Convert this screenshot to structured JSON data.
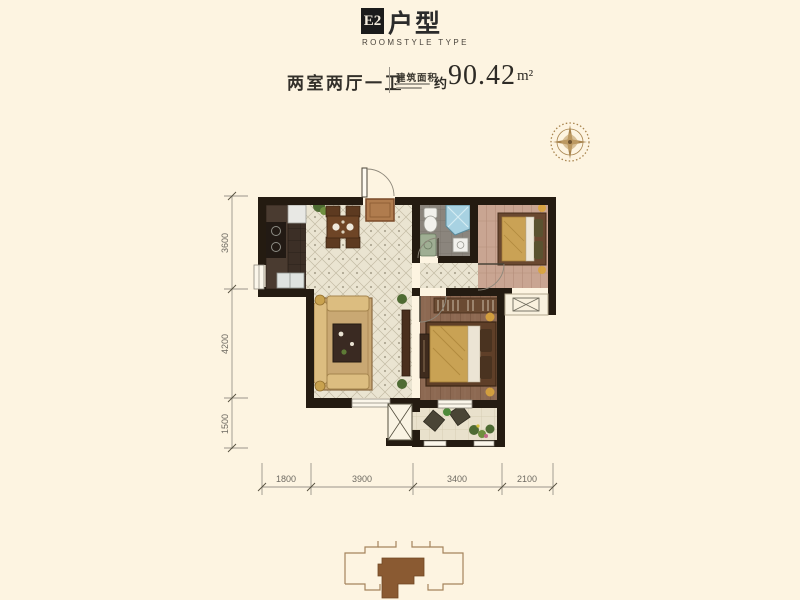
{
  "header": {
    "badge": "E2",
    "title": "户型",
    "subtitle": "ROOMSTYLE TYPE"
  },
  "info": {
    "layout": "两室两厅一卫",
    "area_label": "建筑面积",
    "approx": "约",
    "area_value": "90.42",
    "area_unit": "m²"
  },
  "dimensions": {
    "left": [
      "3600",
      "4200",
      "1500"
    ],
    "bottom": [
      "1800",
      "3900",
      "3400",
      "2100"
    ]
  },
  "icons": {
    "compass": "compass-rose-icon",
    "flue": "flue-x-icon",
    "ac_platform": "ac-platform-x-icon"
  },
  "colors": {
    "background": "#fdf4e1",
    "badge_bg": "#1b1b1b",
    "wall": "#241b11",
    "tile_floor": "#eae4d1",
    "master_wood": "#8d6952",
    "secondary_wood": "#c9a592",
    "kitchen_floor": "#3c2f26",
    "bath_floor": "#8b857d",
    "balcony_floor": "#e9e1cc",
    "keyplan_fill": "#8a5a32",
    "compass": "#a8844e"
  }
}
